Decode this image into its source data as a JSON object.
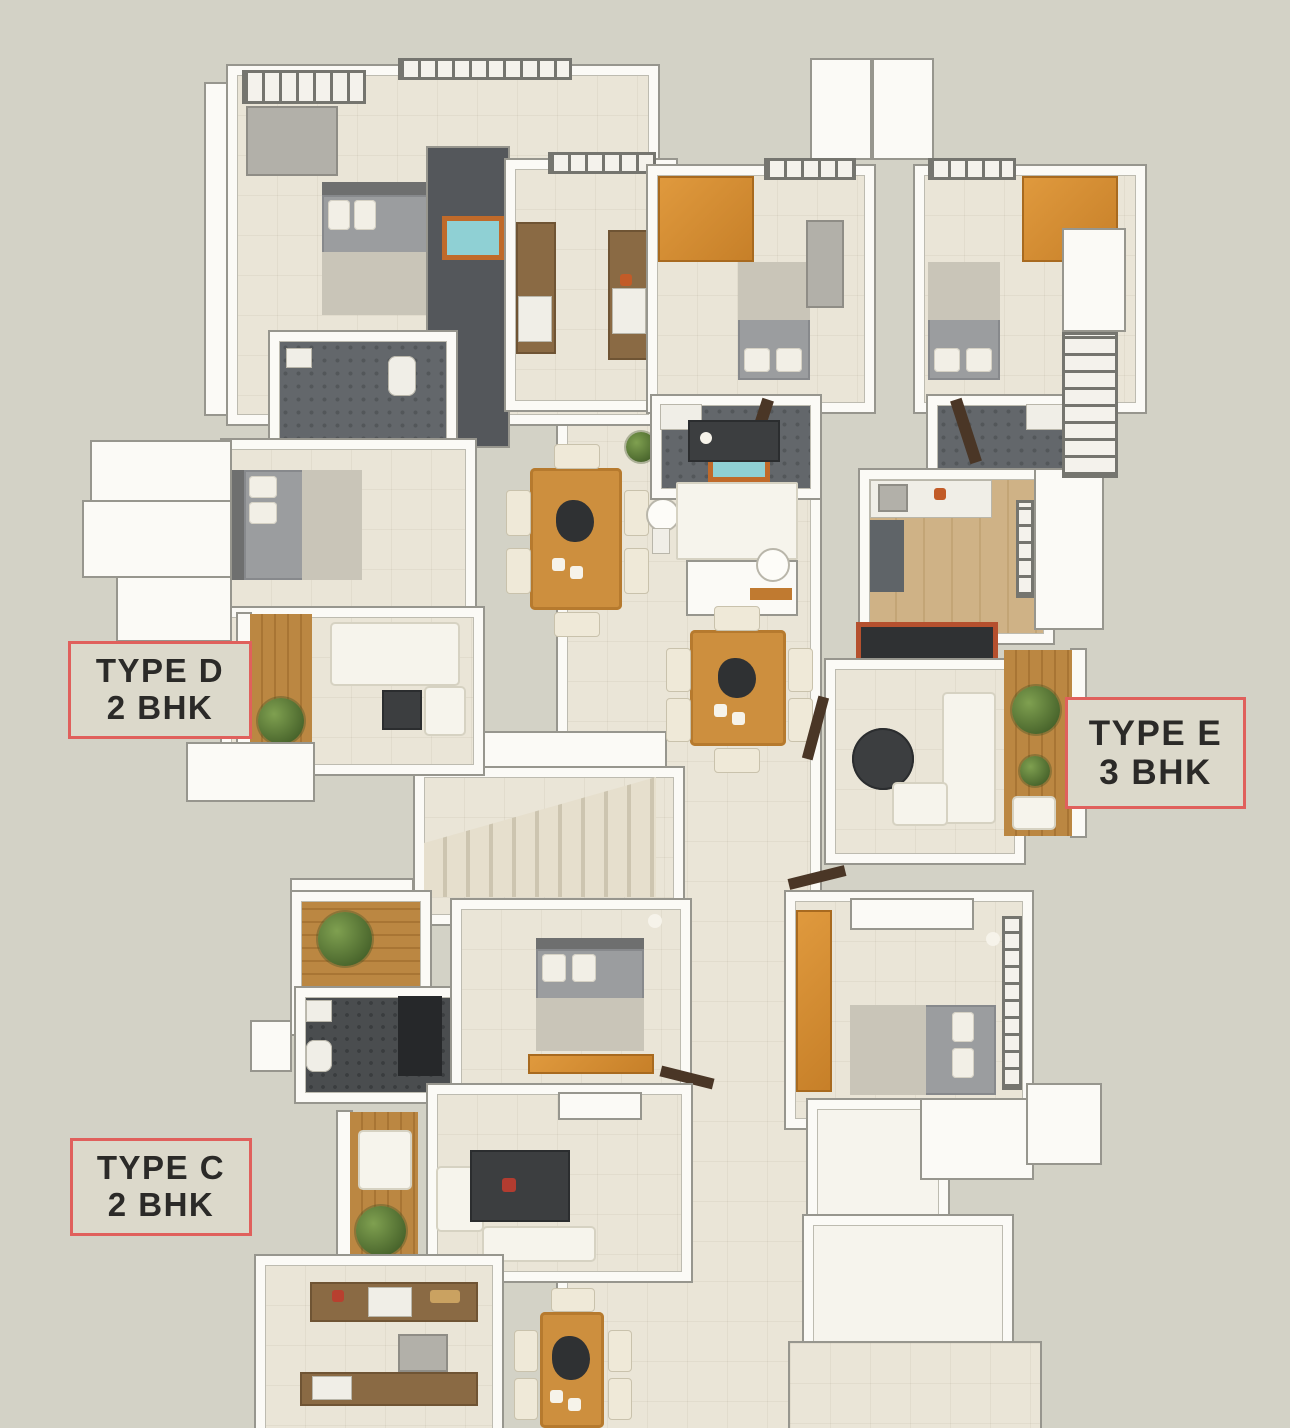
{
  "title": "Apartment cluster 3D floor plan",
  "labels": [
    {
      "id": "type-d",
      "line1": "TYPE D",
      "line2": "2 BHK"
    },
    {
      "id": "type-e",
      "line1": "TYPE E",
      "line2": "3 BHK"
    },
    {
      "id": "type-c",
      "line1": "TYPE C",
      "line2": "2 BHK"
    }
  ],
  "palette": {
    "background": "#d3d2c6",
    "wall_white": "#fbfaf6",
    "wall_edge_gray": "#97968e",
    "floor_cream_tile": "#eae5d7",
    "floor_wood": "#cfb286",
    "balcony_deck_wood": "#bb8742",
    "bathroom_tile_gray": "#63676b",
    "bathroom_tile_dark": "#4a4d4f",
    "bed_gray": "#9b9d9f",
    "blanket_beige": "#c9c5b8",
    "wardrobe_orange": "#d0862f",
    "dining_table_wood": "#cd8f3e",
    "chair_cream": "#efe9d8",
    "plant_green": "#5c7d3d",
    "label_border_red": "#e0605c",
    "label_text": "#2b2a28",
    "mirror_teal": "#8fd0d4",
    "tv_frame_red": "#b5502e"
  }
}
